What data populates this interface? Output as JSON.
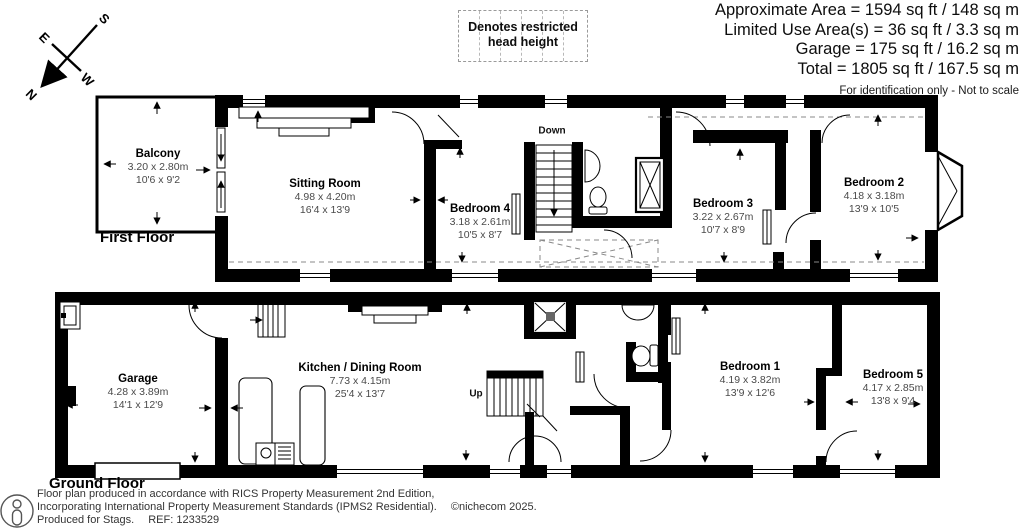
{
  "header": {
    "area_lines": [
      "Approximate Area = 1594 sq ft / 148 sq m",
      "Limited Use Area(s) = 36 sq ft / 3.3 sq m",
      "Garage = 175 sq ft / 16.2 sq m",
      "Total = 1805 sq ft / 167.5 sq m"
    ],
    "note": "For identification only - Not to scale",
    "legend": {
      "line1": "Denotes restricted",
      "line2": "head height"
    }
  },
  "compass": {
    "north": "N",
    "south": "S",
    "east": "E",
    "west": "W"
  },
  "floors": {
    "first": {
      "label": "First Floor"
    },
    "ground": {
      "label": "Ground Floor"
    }
  },
  "rooms": {
    "balcony": {
      "name": "Balcony",
      "metric": "3.20 x 2.80m",
      "imperial": "10'6 x 9'2"
    },
    "sitting_room": {
      "name": "Sitting Room",
      "metric": "4.98 x 4.20m",
      "imperial": "16'4 x 13'9"
    },
    "bedroom4": {
      "name": "Bedroom 4",
      "metric": "3.18 x 2.61m",
      "imperial": "10'5 x 8'7"
    },
    "bedroom3": {
      "name": "Bedroom 3",
      "metric": "3.22 x 2.67m",
      "imperial": "10'7 x 8'9"
    },
    "bedroom2": {
      "name": "Bedroom 2",
      "metric": "4.18 x 3.18m",
      "imperial": "13'9 x 10'5"
    },
    "garage": {
      "name": "Garage",
      "metric": "4.28 x 3.89m",
      "imperial": "14'1 x 12'9"
    },
    "kitchen_dining": {
      "name": "Kitchen / Dining Room",
      "metric": "7.73 x 4.15m",
      "imperial": "25'4 x 13'7"
    },
    "bedroom1": {
      "name": "Bedroom 1",
      "metric": "4.19 x 3.82m",
      "imperial": "13'9 x 12'6"
    },
    "bedroom5": {
      "name": "Bedroom 5",
      "metric": "4.17 x 2.85m",
      "imperial": "13'8 x 9'4"
    }
  },
  "stairs": {
    "down": "Down",
    "up": "Up"
  },
  "footer": {
    "line1": "Floor plan produced in accordance with RICS Property Measurement 2nd Edition,",
    "line2": "Incorporating International Property Measurement Standards (IPMS2 Residential).",
    "copyright": "©nichecom 2025.",
    "line3": "Produced for Stags.",
    "ref": "REF: 1233529"
  },
  "colors": {
    "wall": "#000000",
    "dim_text": "#4a4a4a",
    "dashed": "#888888"
  }
}
